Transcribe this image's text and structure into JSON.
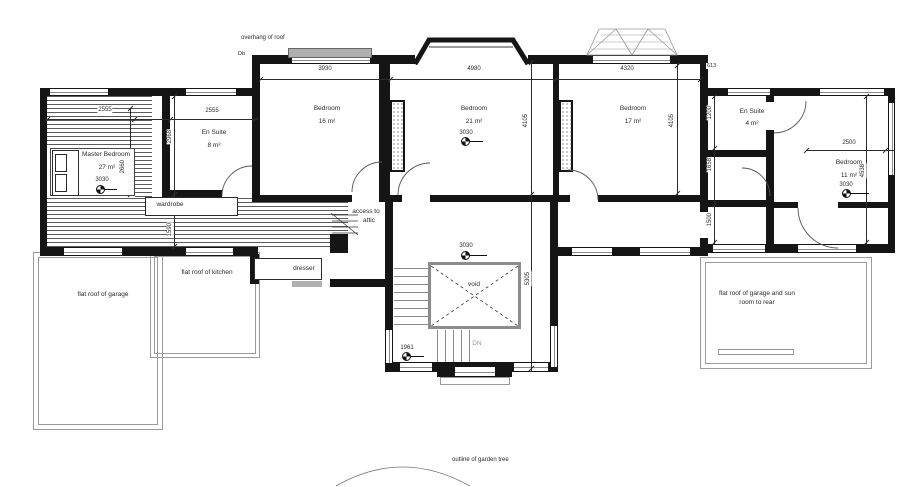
{
  "colors": {
    "wall": "#151515",
    "outline_gray": "#9a9a9a",
    "hatch": "#5a5a5a",
    "text": "#2b2b2b"
  },
  "annotations": {
    "overhang_of_roof": "overhang of roof",
    "db": "Db",
    "access_to_attic_1": "access to",
    "access_to_attic_2": "attic",
    "wardrobe": "wardrobe",
    "dresser": "dresser",
    "void": "void",
    "down": "DN",
    "flat_roof_of_garage": "flat roof of garage",
    "flat_roof_of_kitchen": "flat roof of kitchen",
    "flat_roof_sun_1": "flat roof of garage and sun",
    "flat_roof_sun_2": "room to rear",
    "garden_tree": "outline of garden tree"
  },
  "rooms": {
    "master": {
      "name": "Master Bedroom",
      "area": "27 m²"
    },
    "bedroom16": {
      "name": "Bedroom",
      "area": "16 m²"
    },
    "bedroom21": {
      "name": "Bedroom",
      "area": "21 m²"
    },
    "bedroom17": {
      "name": "Bedroom",
      "area": "17 m²"
    },
    "bedroom11": {
      "name": "Bedroom",
      "area": "11 m²"
    },
    "ensuite8": {
      "name": "En Suite",
      "area": "8 m²"
    },
    "ensuite4": {
      "name": "En Suite",
      "area": "4 m²"
    }
  },
  "dimensions": {
    "bedroom16_width": "3930",
    "bedroom21_width": "4980",
    "bedroom17_width": "4320",
    "bedroom21_depth": "4105",
    "bedroom17_depth": "4105",
    "master_strip_width": "2555",
    "ensuite8_width": "2555",
    "ensuite8_depth": "2968",
    "master_bed_depth": "2660",
    "landing_width": "1590",
    "ensuite4_depth": "1200",
    "dressing_depth": "1658",
    "corridor_depth": "1500",
    "bedroom11_width": "2500",
    "bedroom11_depth": "4538",
    "stairwell_depth": "5305",
    "eaves_offset": "613"
  },
  "level_markers": {
    "m3030": "3030",
    "m1961": "1961"
  }
}
